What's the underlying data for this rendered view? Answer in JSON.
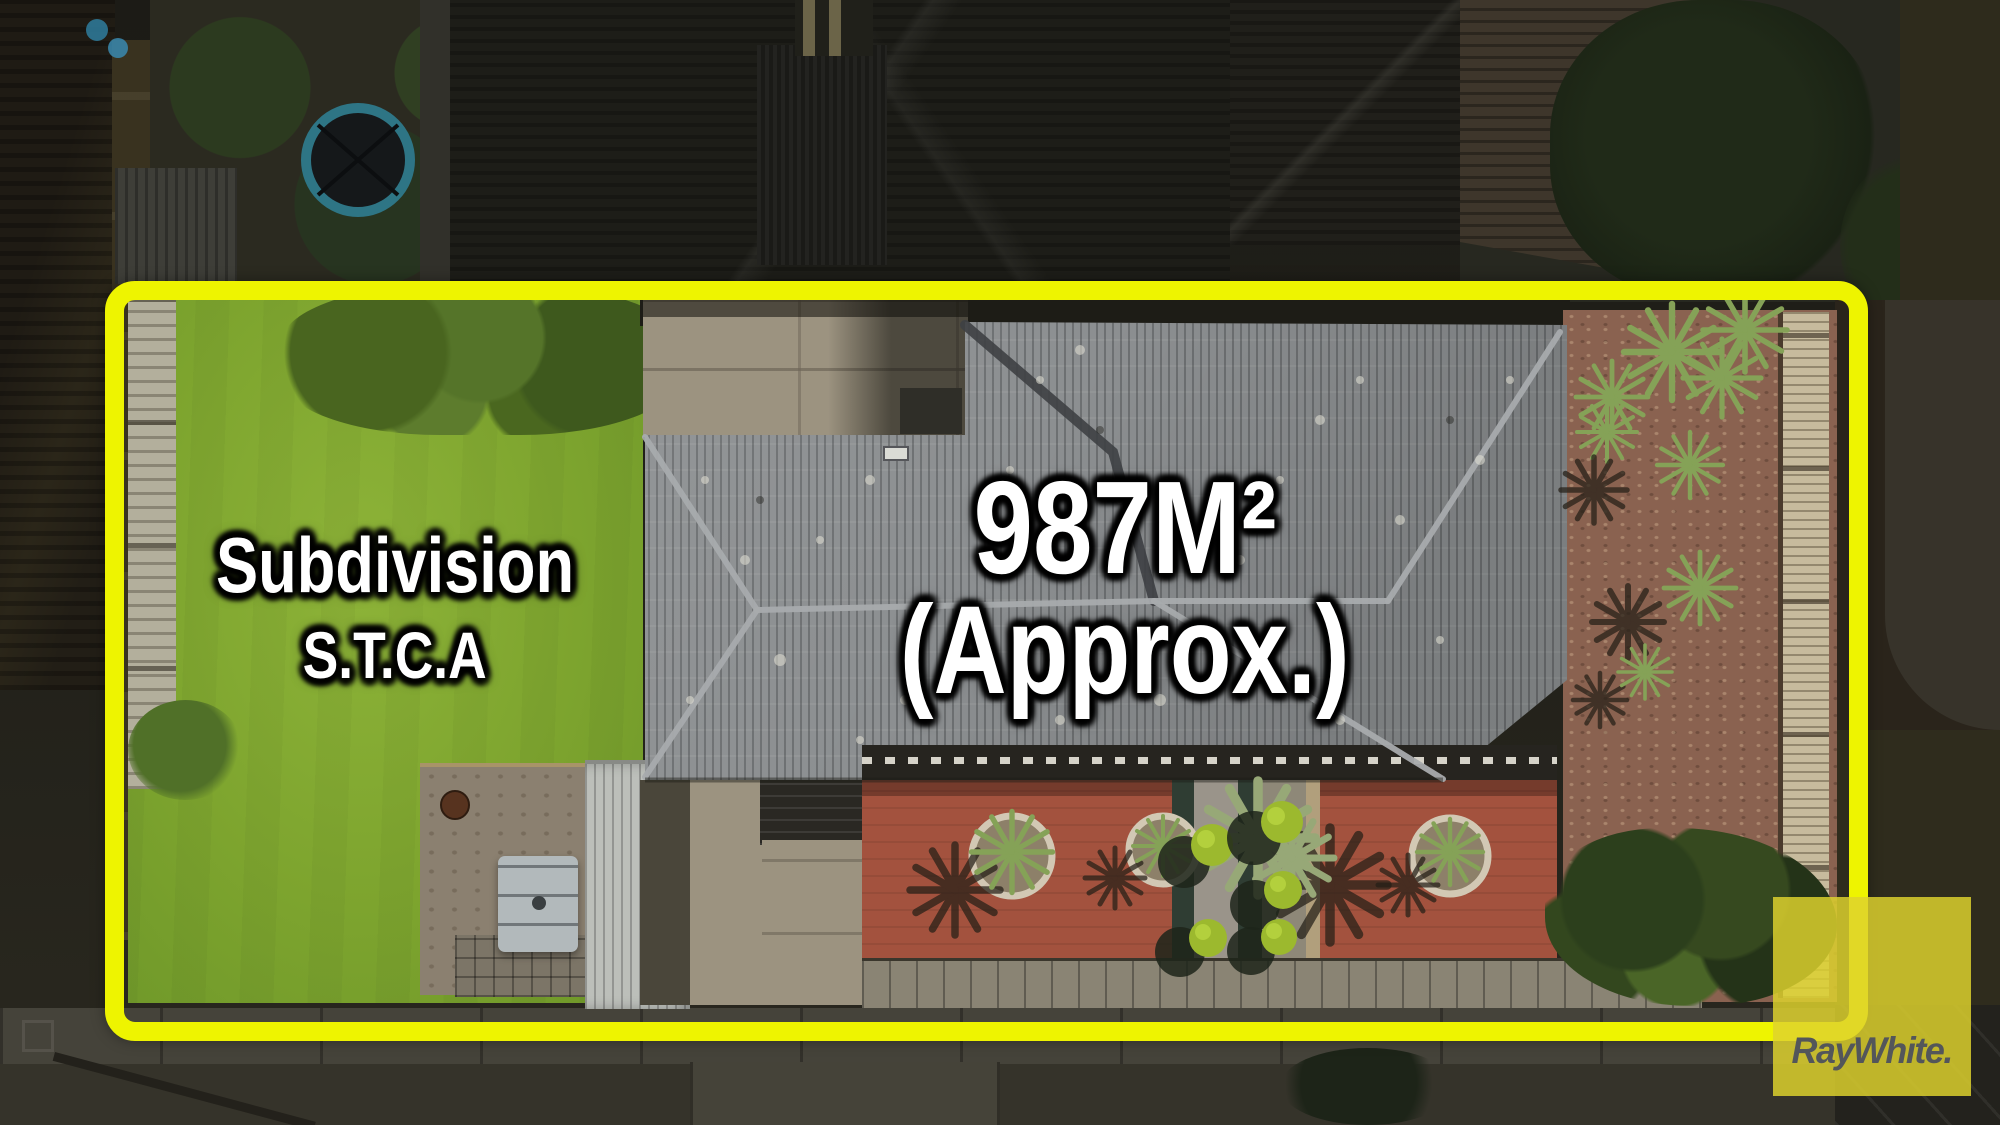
{
  "annotations": {
    "subdivision": {
      "line1": "Subdivision",
      "line2": "S.T.C.A"
    },
    "area": {
      "line1": "987M²",
      "line2": "(Approx.)"
    }
  },
  "logo": {
    "brand": "RayWhite."
  },
  "colors": {
    "boundary_yellow": "#eef400",
    "logo_yellow": "#ded22d",
    "logo_text_gray": "#53565a",
    "lawn_green": "#7da42e",
    "roof_gray": "#8c8f91",
    "mulch_brown": "#8a6250",
    "front_paving_red": "#a3523e"
  }
}
